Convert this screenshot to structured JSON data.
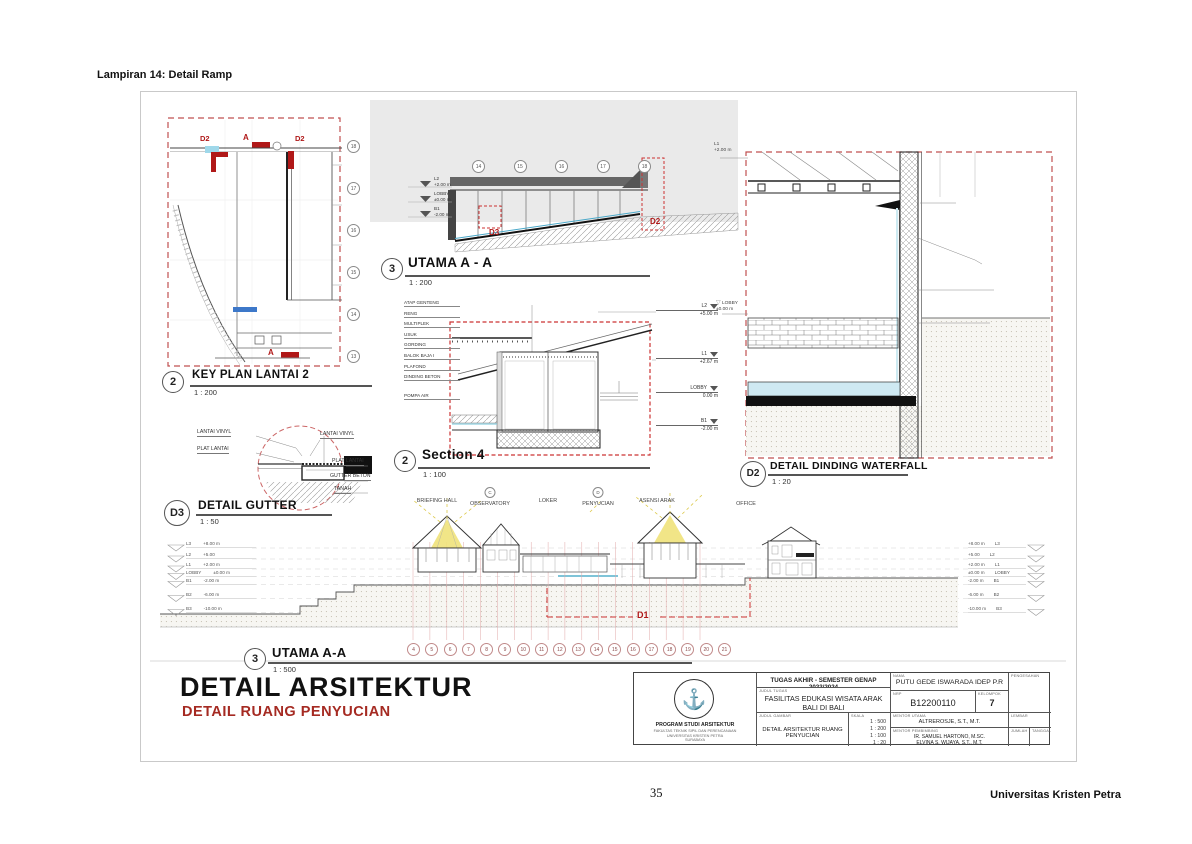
{
  "page": {
    "header_label": "Lampiran 14: Detail Ramp",
    "page_number": "35",
    "publisher": "Universitas Kristen Petra"
  },
  "key_plan": {
    "num": "2",
    "title": "KEY PLAN LANTAI 2",
    "scale": "1 : 200",
    "bubbles": [
      "18",
      "17",
      "16",
      "15",
      "14",
      "13"
    ],
    "marker_d2_left": "D2",
    "marker_d2_right": "D2",
    "marker_a_top": "A",
    "marker_a_bottom": "A"
  },
  "utama_top": {
    "num": "3",
    "title": "UTAMA A - A",
    "scale": "1 : 200",
    "bubbles": [
      "14",
      "15",
      "16",
      "17",
      "18"
    ],
    "levels": [
      {
        "name": "L2",
        "value": "+2.00 m"
      },
      {
        "name": "LOBBY",
        "value": "±0.00 m"
      },
      {
        "name": "B1",
        "value": "-2.00 m"
      }
    ],
    "marker_d3": "D3",
    "marker_d2": "D2"
  },
  "section4": {
    "num": "2",
    "title": "Section 4",
    "scale": "1 : 100",
    "material_labels": [
      "ATAP GENTENG",
      "RENG",
      "MULTIPLEK",
      "USUK",
      "GORDING",
      "BALOK BAJA I",
      "PLAFOND",
      "DINDING BETON",
      "POMPA AIR"
    ],
    "levels": [
      {
        "name": "L2",
        "value": "+5.00 m"
      },
      {
        "name": "L1",
        "value": "+2.67 m"
      },
      {
        "name": "LOBBY",
        "value": "0.00 m"
      },
      {
        "name": "B1",
        "value": "-2.00 m"
      }
    ]
  },
  "waterfall": {
    "num": "D2",
    "title": "DETAIL DINDING WATERFALL",
    "scale": "1 : 20",
    "levels": [
      {
        "name": "L1",
        "value": "+2.00 m"
      },
      {
        "name": "LOBBY",
        "value": "±0.00 m"
      }
    ],
    "part_labels": [
      "CONCRETE WATER FOUNTAIN",
      "PIPA PVC 1/2 INCH",
      "DINDING BATA",
      "DINDING BETON"
    ]
  },
  "gutter": {
    "num": "D3",
    "title": "DETAIL GUTTER",
    "scale": "1 : 50",
    "left_labels": [
      "LANTAI VINYL",
      "PLAT LANTAI"
    ],
    "right_labels": [
      "LANTAI VINYL",
      "PLAT LANTAI",
      "GUTTER BETON",
      "TANAH"
    ]
  },
  "elevation": {
    "num": "3",
    "title": "UTAMA A-A",
    "scale": "1 : 500",
    "rooms": [
      {
        "label": "BRIEFING HALL"
      },
      {
        "label": "OBSERVATORY",
        "bubble": "C"
      },
      {
        "label": "LOKER"
      },
      {
        "label": "PENYUCIAN",
        "bubble": "D"
      },
      {
        "label": "ASENSI ARAK"
      },
      {
        "label": "OFFICE"
      }
    ],
    "levels_left": [
      {
        "name": "L3",
        "value": "+8.00 m"
      },
      {
        "name": "L2",
        "value": "+5.00"
      },
      {
        "name": "L1",
        "value": "+2.00 m"
      },
      {
        "name": "LOBBY",
        "value": "±0.00 m"
      },
      {
        "name": "B1",
        "value": "-2.00 m"
      },
      {
        "name": "B2",
        "value": "-6.00 m"
      },
      {
        "name": "B3",
        "value": "-10.00 m"
      }
    ],
    "levels_right": [
      {
        "value": "+8.00 m",
        "name": "L3"
      },
      {
        "value": "+5.00",
        "name": "L2"
      },
      {
        "value": "+2.00 m",
        "name": "L1"
      },
      {
        "value": "±0.00 m",
        "name": "LOBBY"
      },
      {
        "value": "-2.00 m",
        "name": "B1"
      },
      {
        "value": "-6.00 m",
        "name": "B2"
      },
      {
        "value": "-10.00 m",
        "name": "B3"
      }
    ],
    "grid_bubbles": [
      "4",
      "5",
      "6",
      "7",
      "8",
      "9",
      "10",
      "11",
      "12",
      "13",
      "14",
      "15",
      "16",
      "17",
      "18",
      "19",
      "20",
      "21"
    ],
    "marker_d1": "D1"
  },
  "sheet_title": {
    "main": "DETAIL ARSITEKTUR",
    "sub": "DETAIL RUANG PENYUCIAN"
  },
  "title_block": {
    "header": "TUGAS AKHIR - SEMESTER GENAP 2023/2024",
    "judul_tugas_label": "JUDUL TUGAS",
    "judul_tugas_1": "FASILITAS EDUKASI WISATA ARAK",
    "judul_tugas_2": "BALI DI BALI",
    "judul_gambar_label": "JUDUL GAMBAR",
    "judul_gambar": "DETAIL ARSITEKTUR RUANG PENYUCIAN",
    "skala_label": "SKALA",
    "skala": [
      "1 : 500",
      "1 : 200",
      "1 : 100",
      "1 : 20"
    ],
    "nama_label": "NAMA",
    "nama": "PUTU GEDE ISWARADA IDEP P.R",
    "nrp_label": "NRP",
    "nrp": "B12200110",
    "kelompok_label": "KELOMPOK",
    "kelompok": "7",
    "mentor_utama_label": "MENTOR UTAMA",
    "mentor_utama": "ALTREROSJE, S.T., M.T.",
    "mentor_pembimbing_label": "MENTOR PEMBIMBING",
    "mentor_pembimbing_1": "IR. SAMUEL HARTONO, M.SC.",
    "mentor_pembimbing_2": "ELVINA S. WIJAYA, S.T., M.T.",
    "pengesahan_label": "PENGESAHAN",
    "lembar_label": "LEMBAR",
    "jumlah_label": "JUMLAH",
    "tanggal_label": "TANGGAL",
    "program_lines": [
      "PROGRAM STUDI ARSITEKTUR",
      "FAKULTAS TEKNIK SIPIL DAN PERENCANAAN",
      "UNIVERSITAS KRISTEN PETRA",
      "SURABAYA"
    ]
  }
}
